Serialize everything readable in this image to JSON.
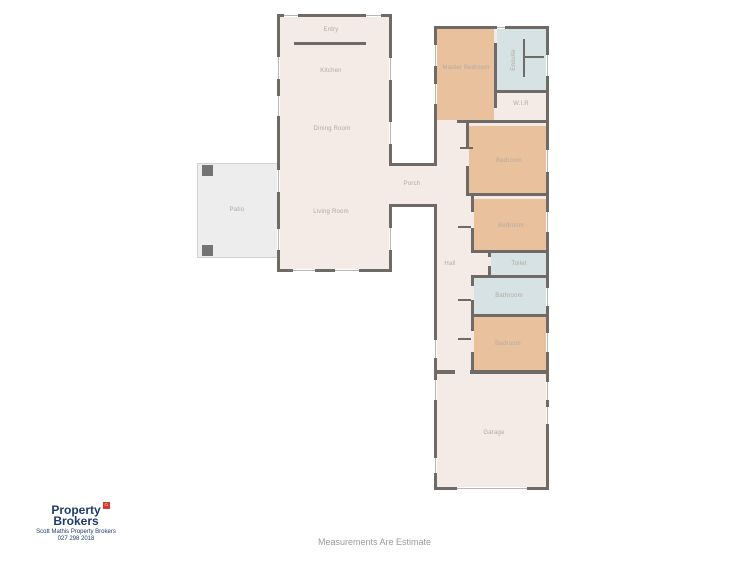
{
  "rooms": {
    "entry": "Entry",
    "kitchen": "Kitchen",
    "dining": "Dining Room",
    "living": "Living Room",
    "patio": "Patio",
    "porch": "Porch",
    "master_bedroom": "Master Bedroom",
    "ensuite": "Ensuite",
    "wir": "W.I.R",
    "bedroom2": "Bedroom",
    "bedroom3": "Bedroom",
    "hall": "Hall",
    "toilet": "Toilet",
    "bathroom": "Bathroom",
    "bedroom4": "Bedroom",
    "garage": "Garage"
  },
  "branding": {
    "name_line1": "Property",
    "name_line2": "Brokers",
    "agent_line": "Scott Mathis Property Brokers",
    "phone": "027 298 2018",
    "house_glyph": "⌂"
  },
  "footer": {
    "disclaimer": "Measurements Are Estimate"
  },
  "colors": {
    "wall": "#6f6a66",
    "floor": "#f4ebe6",
    "bedroom_fill": "#e9c19c",
    "wet_area_fill": "#d6e2e3",
    "patio_fill": "#ededed",
    "room_label": "#b3a9a4",
    "brand_navy": "#1d3b6d",
    "brand_red": "#d73a2c",
    "disclaimer_gray": "#9b9b9b"
  }
}
